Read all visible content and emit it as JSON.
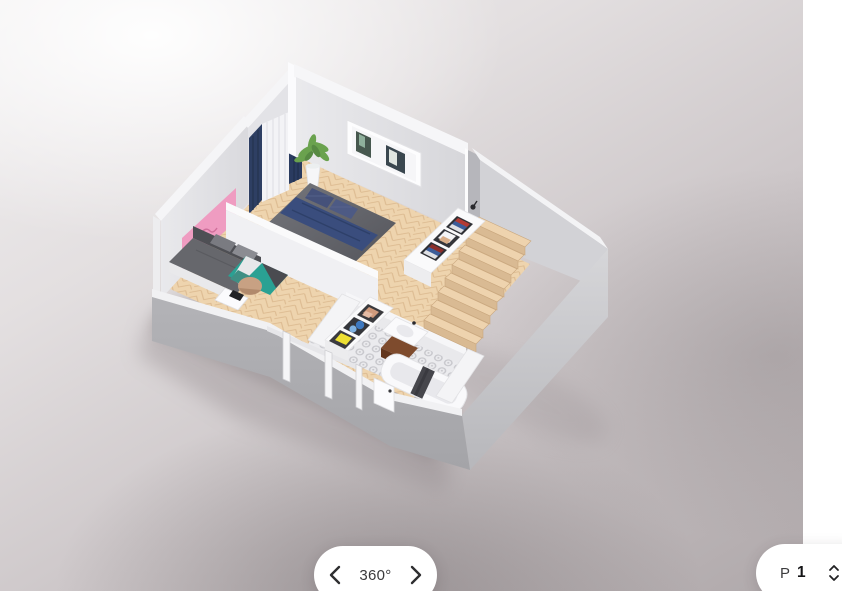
{
  "scene": {
    "description": "3D isometric floor plan render of apartment level P1 on blurred backdrop",
    "rooms": [
      "bedroom",
      "sofa-nook",
      "bathroom",
      "staircase",
      "hallway"
    ],
    "furniture": [
      "double-bed",
      "sofa",
      "area-rug",
      "pouf",
      "side-table",
      "stair-bookshelf",
      "towel-shelf",
      "sink-vanity",
      "bathtub",
      "potted-plant",
      "curtains",
      "pink-wall-art",
      "framed-wall-art"
    ],
    "colors": {
      "wood_floor": "#eed4ae",
      "tile_floor": "#ebebee",
      "wall_light": "#e6e6e9",
      "wall_dark": "#b6b6bb",
      "accent_pink": "#ef9cc1",
      "accent_teal": "#2aa193",
      "accent_navy": "#33456e",
      "accent_yellow": "#eee033",
      "books_red": "#b23a34",
      "books_blue": "#3c5d99"
    }
  },
  "controls": {
    "rotation": {
      "label": "360°",
      "prev_icon": "chevron-left",
      "next_icon": "chevron-right"
    },
    "floor": {
      "prefix": "P",
      "value": "1",
      "stepper_icon": "up-down-chevrons"
    }
  }
}
